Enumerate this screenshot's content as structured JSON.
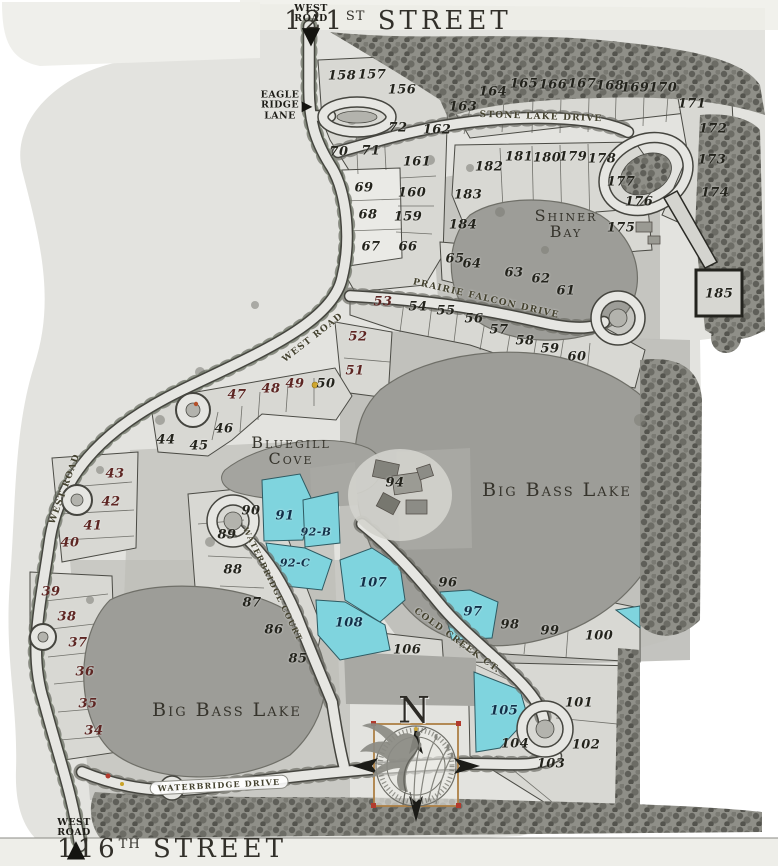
{
  "titles": {
    "top_street": {
      "number": "121",
      "ordinal": "ST",
      "word": "STREET"
    },
    "bottom_street": {
      "number": "116",
      "ordinal": "TH",
      "word": "STREET"
    }
  },
  "arrow_labels": {
    "west_road_top": {
      "line1": "WEST",
      "line2": "ROAD"
    },
    "eagle_ridge": {
      "line1": "EAGLE",
      "line2": "RIDGE",
      "line3": "LANE"
    },
    "west_road_bottom": {
      "line1": "WEST",
      "line2": "ROAD"
    }
  },
  "icons": {
    "arrow_down": "▼",
    "arrow_up": "▲",
    "arrow_right": "▶"
  },
  "road_labels": {
    "stone_lake": "STONE LAKE DRIVE",
    "prairie_falcon": "PRAIRIE FALCON DRIVE",
    "west_road_mid": "WEST ROAD",
    "west_road_left": "WEST ROAD",
    "waterbridge_court": "WATERBRIDGE COURT",
    "cold_creek": "COLD CREEK CT.",
    "waterbridge_drive": "WATERBRIDGE DRIVE"
  },
  "lake_labels": {
    "shiner_line1": "Shiner",
    "shiner_line2": "Bay",
    "big_bass_right": "Big Bass Lake",
    "big_bass_left": "Big Bass Lake",
    "bluegill_line1": "Bluegill",
    "bluegill_line2": "Cove"
  },
  "compass": {
    "north": "N"
  },
  "colors": {
    "available_lot": "#7fd4de",
    "sold_number": "#5d2522",
    "open_number": "#23231c",
    "available_number": "#123049"
  },
  "lots": [
    {
      "n": "34",
      "x": 94,
      "y": 731,
      "s": "sold"
    },
    {
      "n": "35",
      "x": 88,
      "y": 704,
      "s": "sold"
    },
    {
      "n": "36",
      "x": 85,
      "y": 672,
      "s": "sold"
    },
    {
      "n": "37",
      "x": 78,
      "y": 643,
      "s": "sold"
    },
    {
      "n": "38",
      "x": 67,
      "y": 617,
      "s": "sold"
    },
    {
      "n": "39",
      "x": 51,
      "y": 592,
      "s": "sold"
    },
    {
      "n": "40",
      "x": 70,
      "y": 543,
      "s": "sold"
    },
    {
      "n": "41",
      "x": 93,
      "y": 526,
      "s": "sold"
    },
    {
      "n": "42",
      "x": 111,
      "y": 502,
      "s": "sold"
    },
    {
      "n": "43",
      "x": 115,
      "y": 474,
      "s": "sold"
    },
    {
      "n": "44",
      "x": 166,
      "y": 440,
      "s": "open"
    },
    {
      "n": "45",
      "x": 199,
      "y": 446,
      "s": "open"
    },
    {
      "n": "46",
      "x": 224,
      "y": 429,
      "s": "open"
    },
    {
      "n": "47",
      "x": 237,
      "y": 395,
      "s": "sold"
    },
    {
      "n": "48",
      "x": 271,
      "y": 389,
      "s": "sold"
    },
    {
      "n": "49",
      "x": 295,
      "y": 384,
      "s": "sold"
    },
    {
      "n": "50",
      "x": 326,
      "y": 384,
      "s": "open"
    },
    {
      "n": "51",
      "x": 355,
      "y": 371,
      "s": "sold"
    },
    {
      "n": "52",
      "x": 358,
      "y": 337,
      "s": "sold"
    },
    {
      "n": "53",
      "x": 383,
      "y": 302,
      "s": "sold"
    },
    {
      "n": "54",
      "x": 418,
      "y": 307,
      "s": "open"
    },
    {
      "n": "55",
      "x": 446,
      "y": 311,
      "s": "open"
    },
    {
      "n": "56",
      "x": 474,
      "y": 319,
      "s": "open"
    },
    {
      "n": "57",
      "x": 499,
      "y": 330,
      "s": "open"
    },
    {
      "n": "58",
      "x": 525,
      "y": 341,
      "s": "open"
    },
    {
      "n": "59",
      "x": 550,
      "y": 349,
      "s": "open"
    },
    {
      "n": "60",
      "x": 577,
      "y": 357,
      "s": "open"
    },
    {
      "n": "61",
      "x": 566,
      "y": 291,
      "s": "open"
    },
    {
      "n": "62",
      "x": 541,
      "y": 279,
      "s": "open"
    },
    {
      "n": "63",
      "x": 514,
      "y": 273,
      "s": "open"
    },
    {
      "n": "64",
      "x": 472,
      "y": 264,
      "s": "open"
    },
    {
      "n": "65",
      "x": 455,
      "y": 259,
      "s": "open"
    },
    {
      "n": "66",
      "x": 408,
      "y": 247,
      "s": "open"
    },
    {
      "n": "67",
      "x": 371,
      "y": 247,
      "s": "open"
    },
    {
      "n": "68",
      "x": 368,
      "y": 215,
      "s": "open"
    },
    {
      "n": "69",
      "x": 364,
      "y": 188,
      "s": "open"
    },
    {
      "n": "70",
      "x": 339,
      "y": 152,
      "s": "open"
    },
    {
      "n": "71",
      "x": 371,
      "y": 151,
      "s": "open"
    },
    {
      "n": "72",
      "x": 398,
      "y": 128,
      "s": "open"
    },
    {
      "n": "85",
      "x": 298,
      "y": 659,
      "s": "open"
    },
    {
      "n": "86",
      "x": 274,
      "y": 630,
      "s": "open"
    },
    {
      "n": "87",
      "x": 252,
      "y": 603,
      "s": "open"
    },
    {
      "n": "88",
      "x": 233,
      "y": 570,
      "s": "open"
    },
    {
      "n": "89",
      "x": 227,
      "y": 535,
      "s": "open"
    },
    {
      "n": "90",
      "x": 251,
      "y": 511,
      "s": "open"
    },
    {
      "n": "91",
      "x": 285,
      "y": 516,
      "s": "avail"
    },
    {
      "n": "92-B",
      "x": 316,
      "y": 532,
      "s": "avail"
    },
    {
      "n": "92-C",
      "x": 295,
      "y": 563,
      "s": "avail"
    },
    {
      "n": "94",
      "x": 395,
      "y": 483,
      "s": "open"
    },
    {
      "n": "96",
      "x": 448,
      "y": 583,
      "s": "open"
    },
    {
      "n": "97",
      "x": 473,
      "y": 612,
      "s": "avail"
    },
    {
      "n": "98",
      "x": 510,
      "y": 625,
      "s": "open"
    },
    {
      "n": "99",
      "x": 550,
      "y": 631,
      "s": "open"
    },
    {
      "n": "100",
      "x": 599,
      "y": 636,
      "s": "open"
    },
    {
      "n": "101",
      "x": 579,
      "y": 703,
      "s": "open"
    },
    {
      "n": "102",
      "x": 586,
      "y": 745,
      "s": "open"
    },
    {
      "n": "103",
      "x": 551,
      "y": 764,
      "s": "open"
    },
    {
      "n": "104",
      "x": 515,
      "y": 744,
      "s": "open"
    },
    {
      "n": "105",
      "x": 504,
      "y": 711,
      "s": "avail"
    },
    {
      "n": "106",
      "x": 407,
      "y": 650,
      "s": "open"
    },
    {
      "n": "107",
      "x": 373,
      "y": 583,
      "s": "avail"
    },
    {
      "n": "108",
      "x": 349,
      "y": 623,
      "s": "avail"
    },
    {
      "n": "156",
      "x": 402,
      "y": 90,
      "s": "open"
    },
    {
      "n": "157",
      "x": 372,
      "y": 75,
      "s": "open"
    },
    {
      "n": "158",
      "x": 342,
      "y": 76,
      "s": "open"
    },
    {
      "n": "159",
      "x": 408,
      "y": 217,
      "s": "open"
    },
    {
      "n": "160",
      "x": 412,
      "y": 193,
      "s": "open"
    },
    {
      "n": "161",
      "x": 417,
      "y": 162,
      "s": "open"
    },
    {
      "n": "162",
      "x": 437,
      "y": 130,
      "s": "open"
    },
    {
      "n": "163",
      "x": 463,
      "y": 107,
      "s": "open"
    },
    {
      "n": "164",
      "x": 493,
      "y": 92,
      "s": "open"
    },
    {
      "n": "165",
      "x": 524,
      "y": 84,
      "s": "open"
    },
    {
      "n": "166",
      "x": 553,
      "y": 85,
      "s": "open"
    },
    {
      "n": "167",
      "x": 582,
      "y": 84,
      "s": "open"
    },
    {
      "n": "168",
      "x": 610,
      "y": 86,
      "s": "open"
    },
    {
      "n": "169",
      "x": 635,
      "y": 88,
      "s": "open"
    },
    {
      "n": "170",
      "x": 663,
      "y": 88,
      "s": "open"
    },
    {
      "n": "171",
      "x": 692,
      "y": 104,
      "s": "open"
    },
    {
      "n": "172",
      "x": 713,
      "y": 129,
      "s": "open"
    },
    {
      "n": "173",
      "x": 712,
      "y": 160,
      "s": "open"
    },
    {
      "n": "174",
      "x": 715,
      "y": 193,
      "s": "open"
    },
    {
      "n": "175",
      "x": 621,
      "y": 228,
      "s": "open"
    },
    {
      "n": "176",
      "x": 639,
      "y": 202,
      "s": "open"
    },
    {
      "n": "177",
      "x": 621,
      "y": 182,
      "s": "open"
    },
    {
      "n": "178",
      "x": 602,
      "y": 159,
      "s": "open"
    },
    {
      "n": "179",
      "x": 573,
      "y": 157,
      "s": "open"
    },
    {
      "n": "180",
      "x": 547,
      "y": 158,
      "s": "open"
    },
    {
      "n": "181",
      "x": 519,
      "y": 157,
      "s": "open"
    },
    {
      "n": "182",
      "x": 489,
      "y": 167,
      "s": "open"
    },
    {
      "n": "183",
      "x": 468,
      "y": 195,
      "s": "open"
    },
    {
      "n": "184",
      "x": 463,
      "y": 225,
      "s": "open"
    },
    {
      "n": "185",
      "x": 719,
      "y": 294,
      "s": "open"
    }
  ]
}
